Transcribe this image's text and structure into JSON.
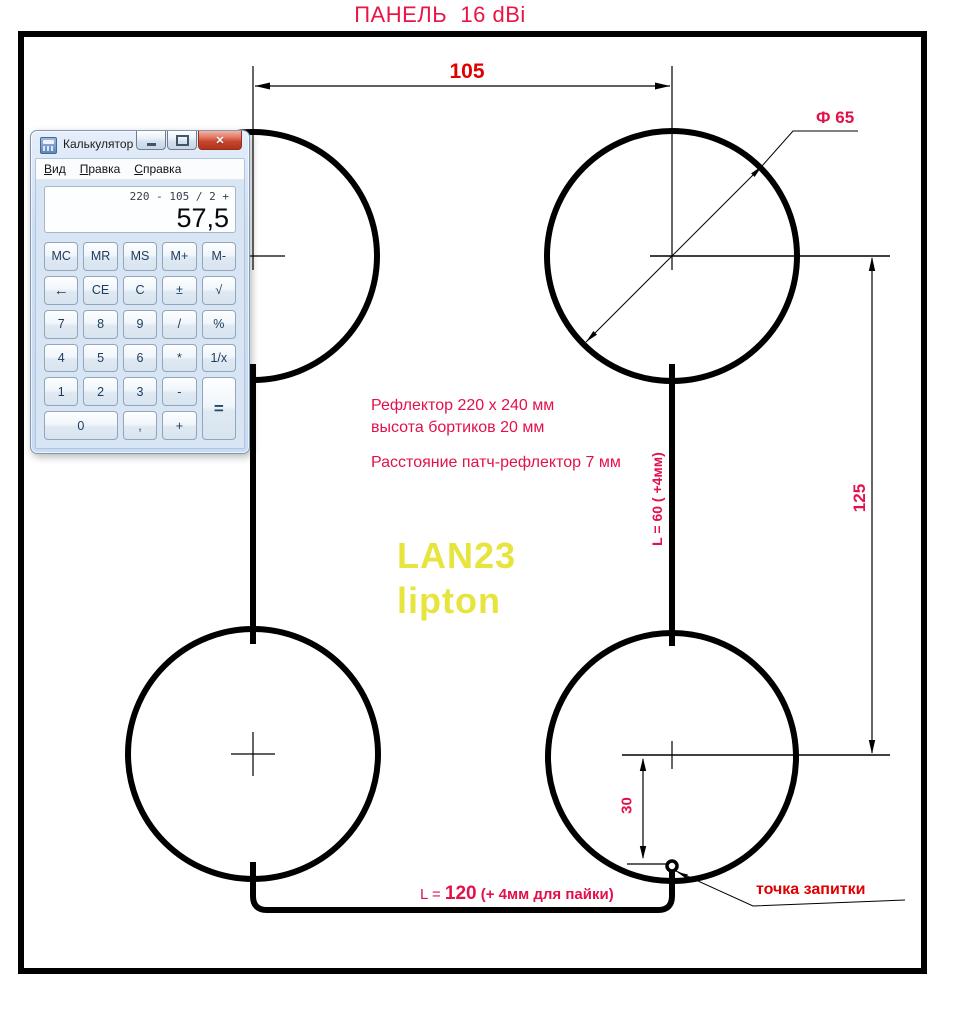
{
  "title": "ПАНЕЛЬ  16 dBi",
  "colors": {
    "dimension_crimson": "#e3114b",
    "accent_red": "#df0000",
    "watermark_yellow": "#e7e43e",
    "line_black": "#000000"
  },
  "drawing": {
    "dim_top": "105",
    "dim_diameter": "Ф 65",
    "dim_right": "125",
    "dim_feed_offset": "30",
    "dim_vertical_wire": "L = 60 ( +4мм)",
    "dim_bottom_wire": {
      "prefix": "L = ",
      "value": "120",
      "suffix": " (+ 4мм для пайки)"
    },
    "feed_point_label": "точка запитки",
    "notes": [
      "Рефлектор 220 x 240 мм",
      "высота бортиков 20 мм",
      "Расстояние патч-рефлектор 7 мм"
    ],
    "watermark_line1": "LAN23",
    "watermark_line2": "lipton"
  },
  "calculator": {
    "window_title": "Калькулятор",
    "close_glyph": "✕",
    "menu": [
      {
        "accel": "В",
        "rest": "ид"
      },
      {
        "accel": "П",
        "rest": "равка"
      },
      {
        "accel": "С",
        "rest": "правка"
      }
    ],
    "history": "220 - 105 / 2 +",
    "result": "57,5",
    "keys": [
      "MC",
      "MR",
      "MS",
      "M+",
      "M-",
      "←",
      "CE",
      "C",
      "±",
      "√",
      "7",
      "8",
      "9",
      "/",
      "%",
      "4",
      "5",
      "6",
      "*",
      "1/x",
      "1",
      "2",
      "3",
      "-",
      "=",
      "0",
      ",",
      "+"
    ]
  }
}
